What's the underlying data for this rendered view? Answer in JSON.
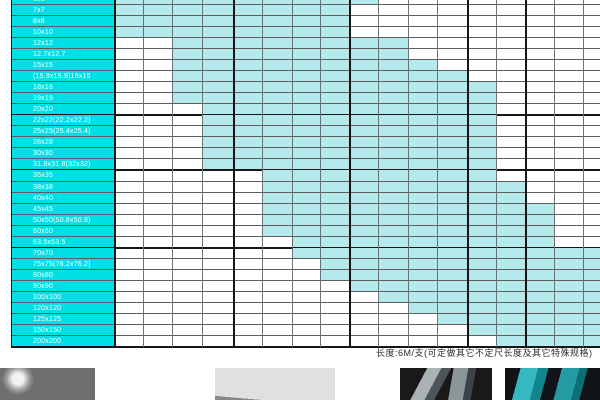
{
  "table": {
    "description_name": "square-tube-size-wall-thickness-availability-matrix",
    "column_edges": [
      114,
      143,
      172,
      202,
      233,
      262,
      292,
      320,
      349,
      378,
      408,
      437,
      467,
      496,
      525,
      554,
      583,
      600
    ],
    "partial_row_height": 5,
    "row_height": 11.032,
    "thick_h_y": [
      115,
      170,
      248,
      347
    ],
    "thick_v_x": [
      114,
      233,
      349,
      467,
      525
    ],
    "rows": [
      {
        "label": "6x6",
        "partial": true,
        "fill_start": 0,
        "fill_end": 8
      },
      {
        "label": "7x7",
        "fill_start": 0,
        "fill_end": 7
      },
      {
        "label": "8x8",
        "fill_start": 0,
        "fill_end": 7
      },
      {
        "label": "10x10",
        "fill_start": 0,
        "fill_end": 7
      },
      {
        "label": "12x12",
        "fill_start": 2,
        "fill_end": 9
      },
      {
        "label": "12.7x12.7",
        "fill_start": 2,
        "fill_end": 9
      },
      {
        "label": "15x15",
        "fill_start": 2,
        "fill_end": 10
      },
      {
        "label": "(15.9x15.9)16x16",
        "fill_start": 2,
        "fill_end": 11
      },
      {
        "label": "18x18",
        "fill_start": 2,
        "fill_end": 12
      },
      {
        "label": "19x19",
        "fill_start": 2,
        "fill_end": 12
      },
      {
        "label": "20x20",
        "fill_start": 3,
        "fill_end": 12
      },
      {
        "label": "22x22(22.2x22.2)",
        "fill_start": 3,
        "fill_end": 12
      },
      {
        "label": "25x25(25.4x25.4)",
        "fill_start": 3,
        "fill_end": 12
      },
      {
        "label": "28x28",
        "fill_start": 3,
        "fill_end": 12
      },
      {
        "label": "30x30",
        "fill_start": 3,
        "fill_end": 12
      },
      {
        "label": "31.8x31.8(32x32)",
        "fill_start": 3,
        "fill_end": 12
      },
      {
        "label": "35x35",
        "fill_start": 5,
        "fill_end": 12
      },
      {
        "label": "38x38",
        "fill_start": 5,
        "fill_end": 13
      },
      {
        "label": "40x40",
        "fill_start": 5,
        "fill_end": 13
      },
      {
        "label": "45x45",
        "fill_start": 5,
        "fill_end": 14
      },
      {
        "label": "50x50(50.8x50.8)",
        "fill_start": 5,
        "fill_end": 14
      },
      {
        "label": "60x60",
        "fill_start": 5,
        "fill_end": 14
      },
      {
        "label": "63.5x63.5",
        "fill_start": 6,
        "fill_end": 14
      },
      {
        "label": "70x70",
        "fill_start": 6,
        "fill_end": 16
      },
      {
        "label": "75x75(76.2x76.2)",
        "fill_start": 7,
        "fill_end": 16
      },
      {
        "label": "80x80",
        "fill_start": 7,
        "fill_end": 16
      },
      {
        "label": "90x90",
        "fill_start": 8,
        "fill_end": 16
      },
      {
        "label": "100x100",
        "fill_start": 9,
        "fill_end": 16
      },
      {
        "label": "120x120",
        "fill_start": 10,
        "fill_end": 16
      },
      {
        "label": "125x125",
        "fill_start": 11,
        "fill_end": 16
      },
      {
        "label": "150x150",
        "fill_start": 12,
        "fill_end": 16
      },
      {
        "label": "200x200",
        "fill_start": 13,
        "fill_end": 16
      }
    ]
  },
  "note": {
    "text": "长度:6M/支(可定做其它不定尺长度及其它特殊规格)"
  },
  "colors": {
    "row_label_bg": "#00dfe6",
    "cell_fill": "#b5eaec",
    "grid_line": "#5d5d5d",
    "thick_line": "#161616",
    "label_text": "#ffffff",
    "note_text": "#2b2b2b"
  },
  "photos": [
    {
      "name": "round-steel-bars-photo"
    },
    {
      "name": "fanned-flat-bars-photo"
    },
    {
      "name": "angle-steel-profiles-photo"
    },
    {
      "name": "teal-square-tubes-photo"
    }
  ]
}
